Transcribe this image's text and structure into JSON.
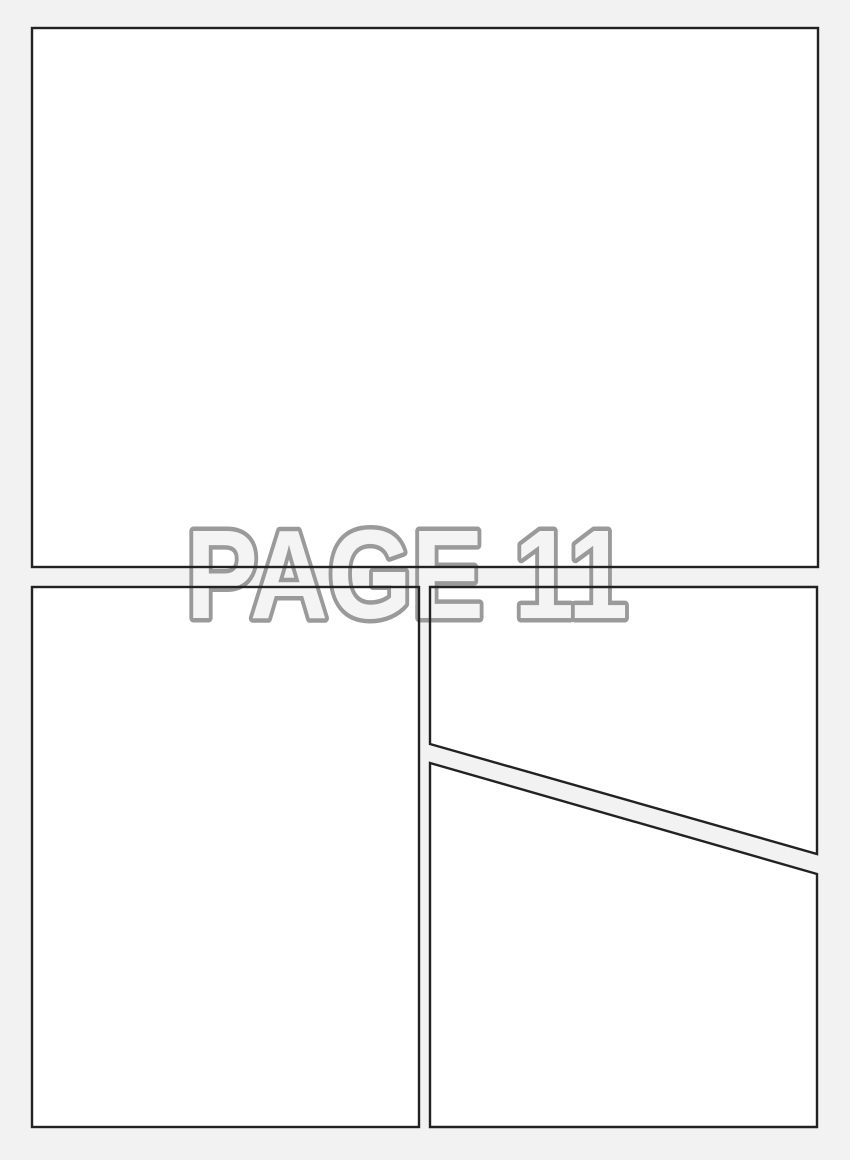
{
  "page": {
    "label": "PAGE 11"
  },
  "colors": {
    "page_background": "#f2f2f2",
    "panel_fill": "#ffffff",
    "panel_border": "#222222",
    "watermark_fill": "#f4f4f4",
    "watermark_outline": "#9a9a9a"
  }
}
